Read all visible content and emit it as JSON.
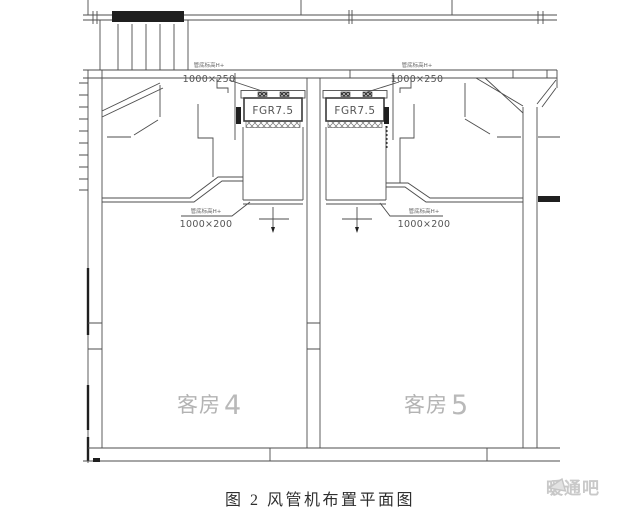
{
  "figure": {
    "caption": "图 2  风管机布置平面图"
  },
  "watermark": {
    "brand": "暖通吧",
    "icon": "megaphone-icon"
  },
  "rooms": [
    {
      "name": "客房",
      "number": "4"
    },
    {
      "name": "客房",
      "number": "5"
    }
  ],
  "units": [
    {
      "model": "FGR7.5"
    },
    {
      "model": "FGR7.5"
    }
  ],
  "duct_labels": {
    "top_left": {
      "note": "管底标高H+",
      "size": "1000×250"
    },
    "top_right": {
      "note": "管底标高H+",
      "size": "1000×250"
    },
    "mid_left": {
      "note": "管底标高H+",
      "size": "1000×200"
    },
    "mid_right": {
      "note": "管底标高H+",
      "size": "1000×200"
    }
  },
  "colors": {
    "line": "#4d4d4d",
    "dark": "#1f1f1f",
    "room_label": "#b3b3b3",
    "caption_text": "#2f2f2f",
    "watermark_text": "#c9c9c9",
    "background": "#ffffff"
  }
}
